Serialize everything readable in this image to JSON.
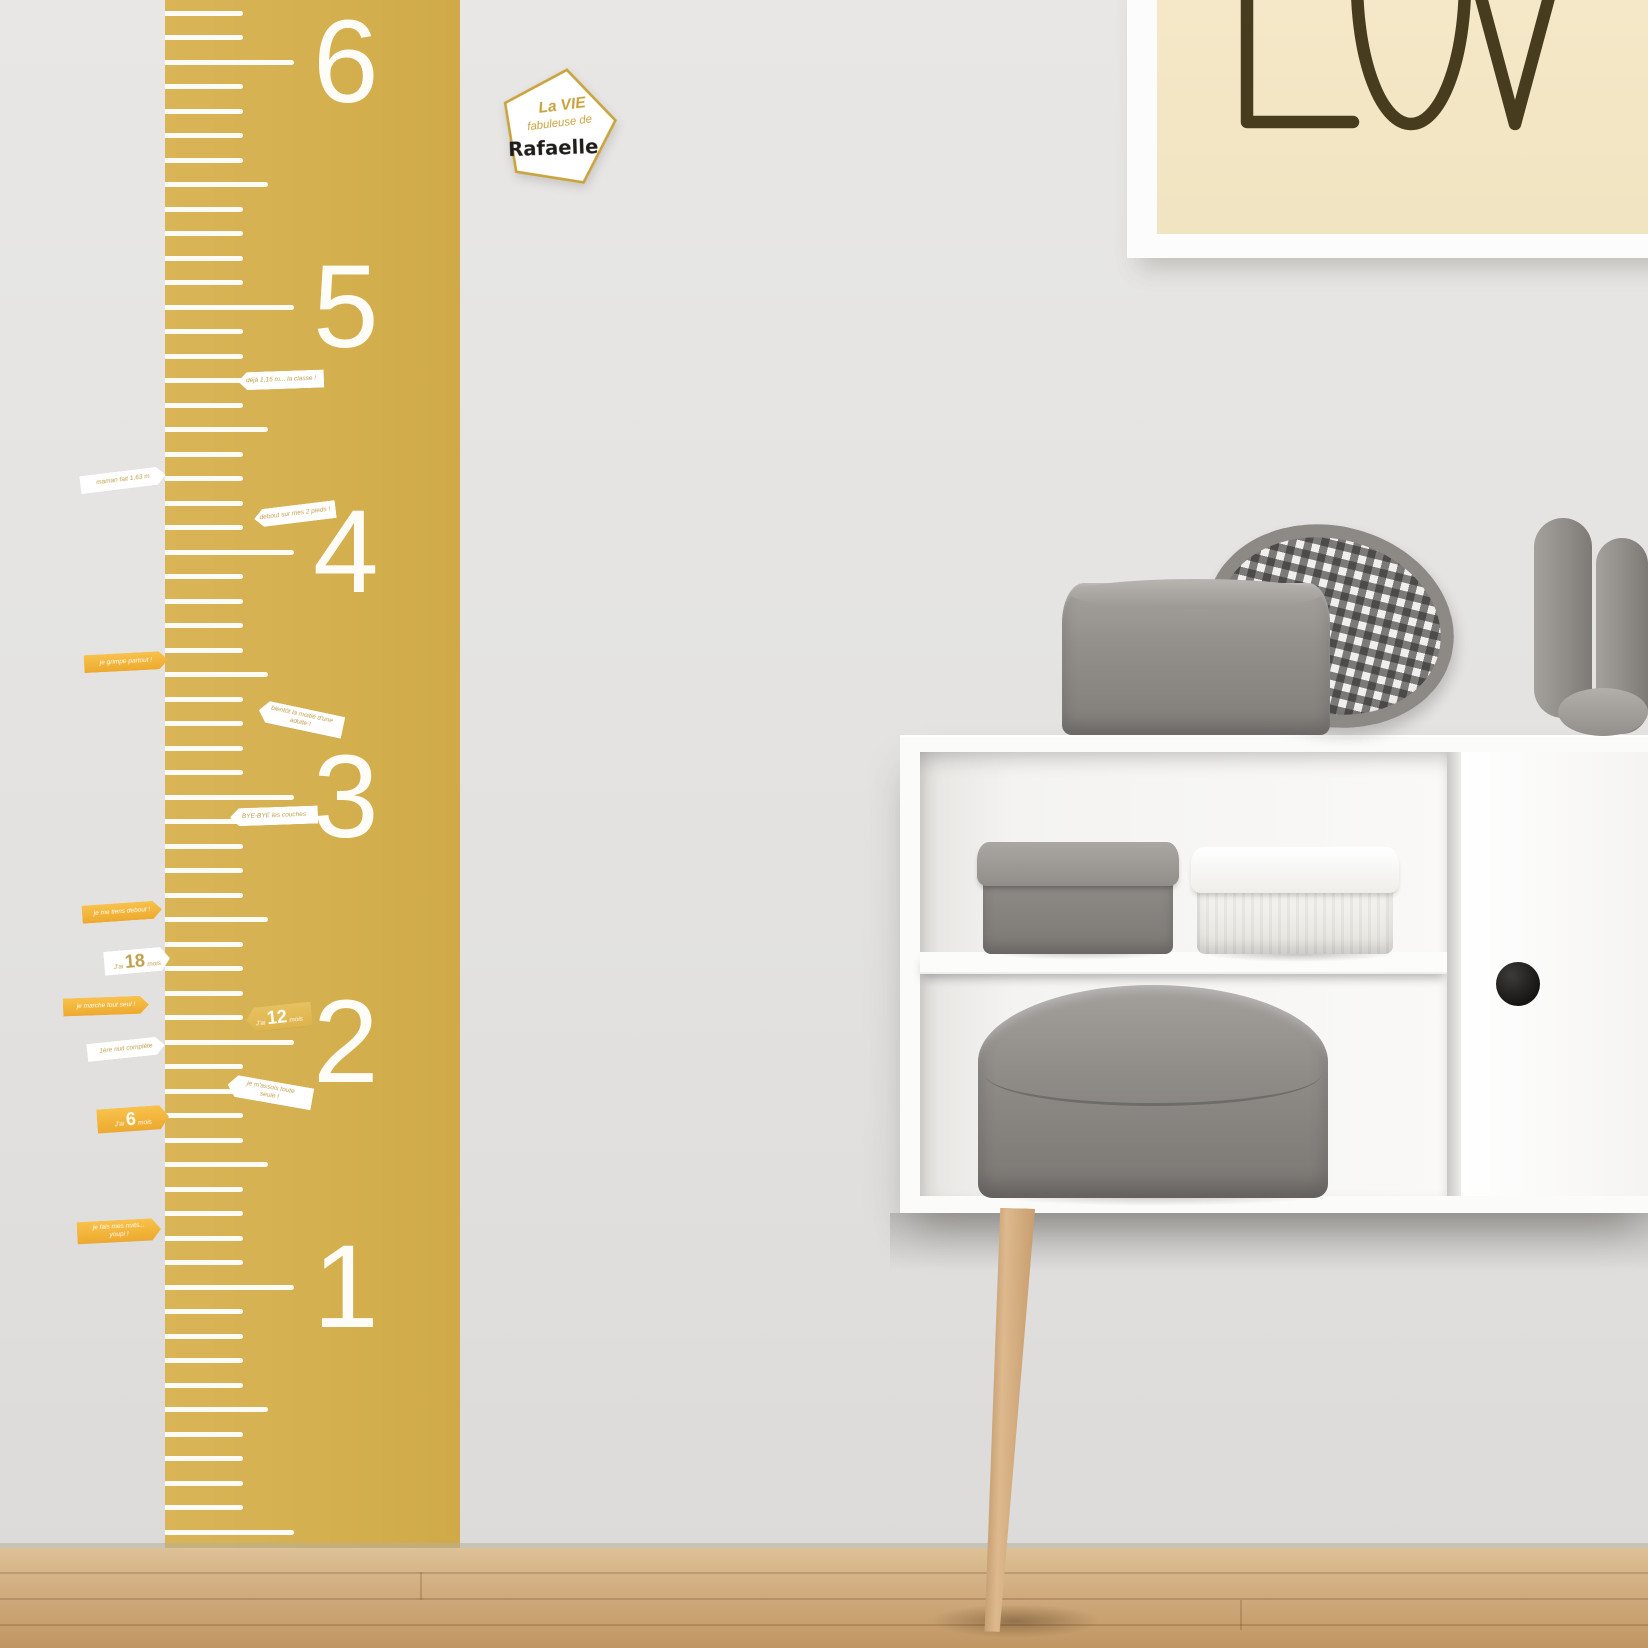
{
  "scene_label": "Kids room wall with mustard growth-chart ruler decal, milestone flag stickers, pentagon name sticker, framed LOVE poster and white sideboard with grey storage boxes on a wooden floor",
  "colors": {
    "ruler": "#d4af4e",
    "wall": "#e4e3e1",
    "floor_wood": "#cda779",
    "flag_orange": "#f0ae33",
    "flag_white": "#ffffff",
    "flag_gold": "#ddb34c",
    "flag_text_gold": "#bfa04e",
    "poster_background": "#f2e6c4",
    "poster_text": "#473c1e",
    "cabinet": "#fbfbfa",
    "box_grey": "#8b8884",
    "knob_black": "#1d1c1a"
  },
  "ruler": {
    "numbers": [
      "6",
      "5",
      "4",
      "3",
      "2",
      "1"
    ]
  },
  "sticker": {
    "line1": "La VIE",
    "line2": "fabuleuse de",
    "name": "Rafaelle"
  },
  "poster": {
    "word": "LOVE",
    "visible_part": "LOV"
  },
  "flags": [
    {
      "style": "white",
      "dir": "right",
      "x": 80,
      "y": 471,
      "w": 86,
      "rot": -7,
      "lines": [
        "maman fait 1,63 m"
      ]
    },
    {
      "style": "white",
      "dir": "left",
      "x": 254,
      "y": 505,
      "w": 82,
      "rot": -7,
      "lines": [
        "debout sur mes 2 pieds !"
      ]
    },
    {
      "style": "white",
      "dir": "left",
      "x": 238,
      "y": 371,
      "w": 86,
      "rot": -2,
      "lines": [
        "déjà 1,15 m... la classe !"
      ]
    },
    {
      "style": "orange",
      "dir": "right",
      "x": 84,
      "y": 653,
      "w": 84,
      "rot": -3,
      "lines": [
        "je grimpe partout !"
      ]
    },
    {
      "style": "white",
      "dir": "left",
      "x": 258,
      "y": 708,
      "w": 86,
      "rot": 12,
      "lines": [
        "bientôt la moitié d'une",
        "adulte !"
      ]
    },
    {
      "style": "white",
      "dir": "left",
      "x": 230,
      "y": 807,
      "w": 88,
      "rot": -2,
      "lines": [
        "BYE-BYE les couches"
      ]
    },
    {
      "style": "orange",
      "dir": "right",
      "x": 82,
      "y": 903,
      "w": 80,
      "rot": -4,
      "lines": [
        "je me tiens debout !"
      ]
    },
    {
      "style": "white",
      "dir": "right",
      "x": 104,
      "y": 949,
      "w": 66,
      "rot": -5,
      "big": {
        "pre": "J'ai",
        "n": "18",
        "post": "mois"
      }
    },
    {
      "style": "orange",
      "dir": "right",
      "x": 63,
      "y": 997,
      "w": 86,
      "rot": -2,
      "lines": [
        "je marche tout seul !"
      ]
    },
    {
      "style": "gold",
      "dir": "left",
      "x": 246,
      "y": 1005,
      "w": 66,
      "rot": -6,
      "big": {
        "pre": "J'ai",
        "n": "12",
        "post": "mois"
      }
    },
    {
      "style": "white",
      "dir": "right",
      "x": 87,
      "y": 1040,
      "w": 78,
      "rot": -6,
      "lines": [
        "1ère nuit complète"
      ]
    },
    {
      "style": "white",
      "dir": "left",
      "x": 227,
      "y": 1081,
      "w": 86,
      "rot": 10,
      "lines": [
        "je m'assois toute",
        "seule !"
      ]
    },
    {
      "style": "orange",
      "dir": "right",
      "x": 97,
      "y": 1107,
      "w": 72,
      "rot": -4,
      "big": {
        "pre": "J'ai",
        "n": "6",
        "post": "mois"
      }
    },
    {
      "style": "orange",
      "dir": "right",
      "x": 77,
      "y": 1220,
      "w": 84,
      "rot": -3,
      "lines": [
        "je fais mes nuits...",
        "youpi !"
      ]
    }
  ]
}
